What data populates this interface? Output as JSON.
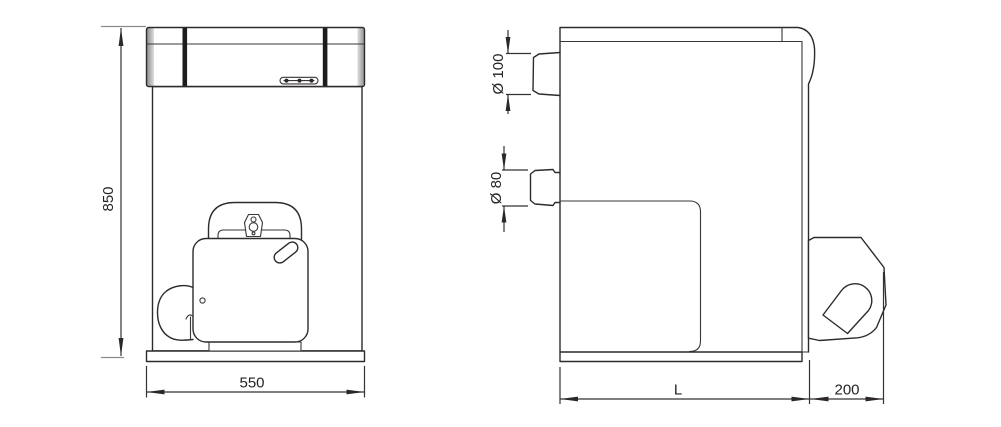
{
  "drawing": {
    "title": "Boiler dimensional drawing, front and side views",
    "background": "#ffffff",
    "line_color": "#2d2b2c",
    "text_color": "#262224",
    "accent_bar_color": "#1c1c1c",
    "front_view": {
      "name": "front view",
      "height_label": "850",
      "width_label": "550"
    },
    "side_view": {
      "name": "side view",
      "flue_diameter_label": "Ø 100",
      "pipe_diameter_label": "Ø 80",
      "depth_label": "L",
      "burner_projection_label": "200"
    }
  }
}
